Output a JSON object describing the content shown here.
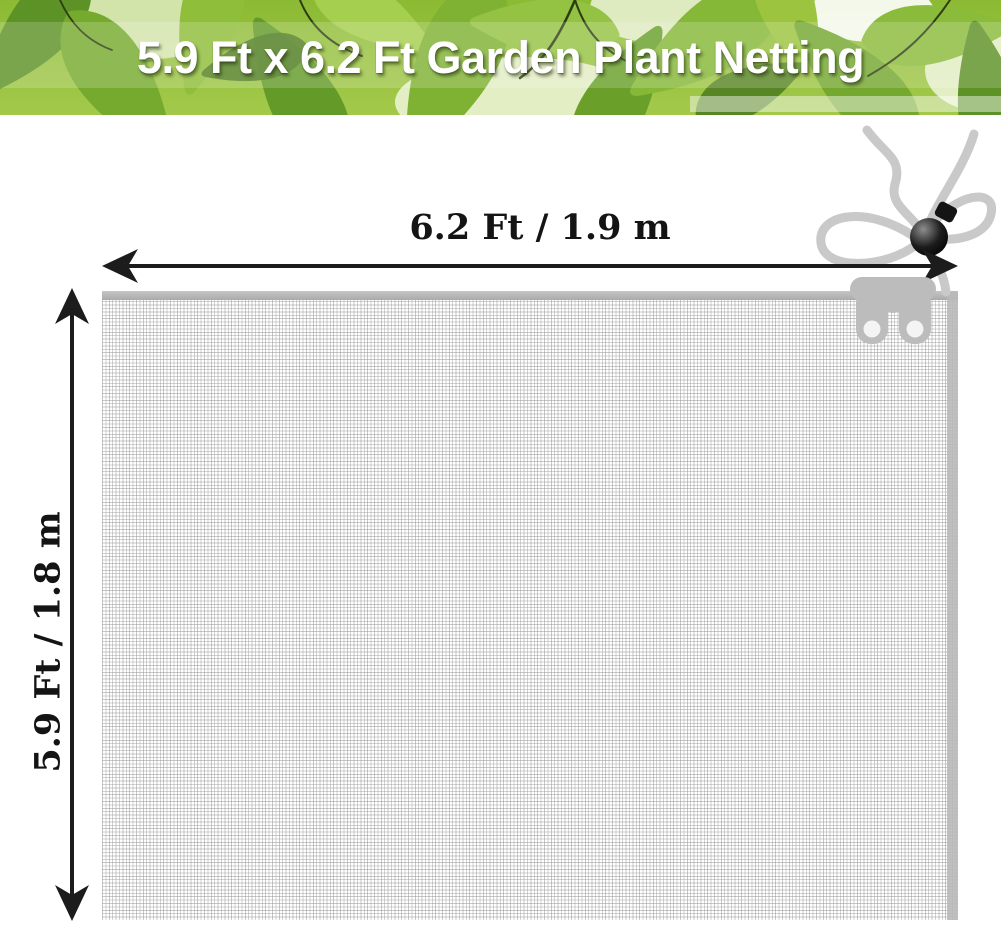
{
  "banner": {
    "title": "5.9 Ft x 6.2 Ft Garden Plant Netting",
    "text_color": "#ffffff"
  },
  "dimension_labels": {
    "width": "6.2 Ft / 1.9 m",
    "height": "5.9 Ft / 1.8 m"
  },
  "colors": {
    "arrow": "#1c1c1c",
    "label_text": "#141414",
    "mesh_line": "#cccccc",
    "hem": "#b5b5b5",
    "cord": "#c9c9c9",
    "toggle": "#141414",
    "zipper_pull": "#bcbcbc",
    "banner_greens": [
      "#4c7a1e",
      "#6fa52c",
      "#9cc43e",
      "#b5d95c"
    ]
  }
}
